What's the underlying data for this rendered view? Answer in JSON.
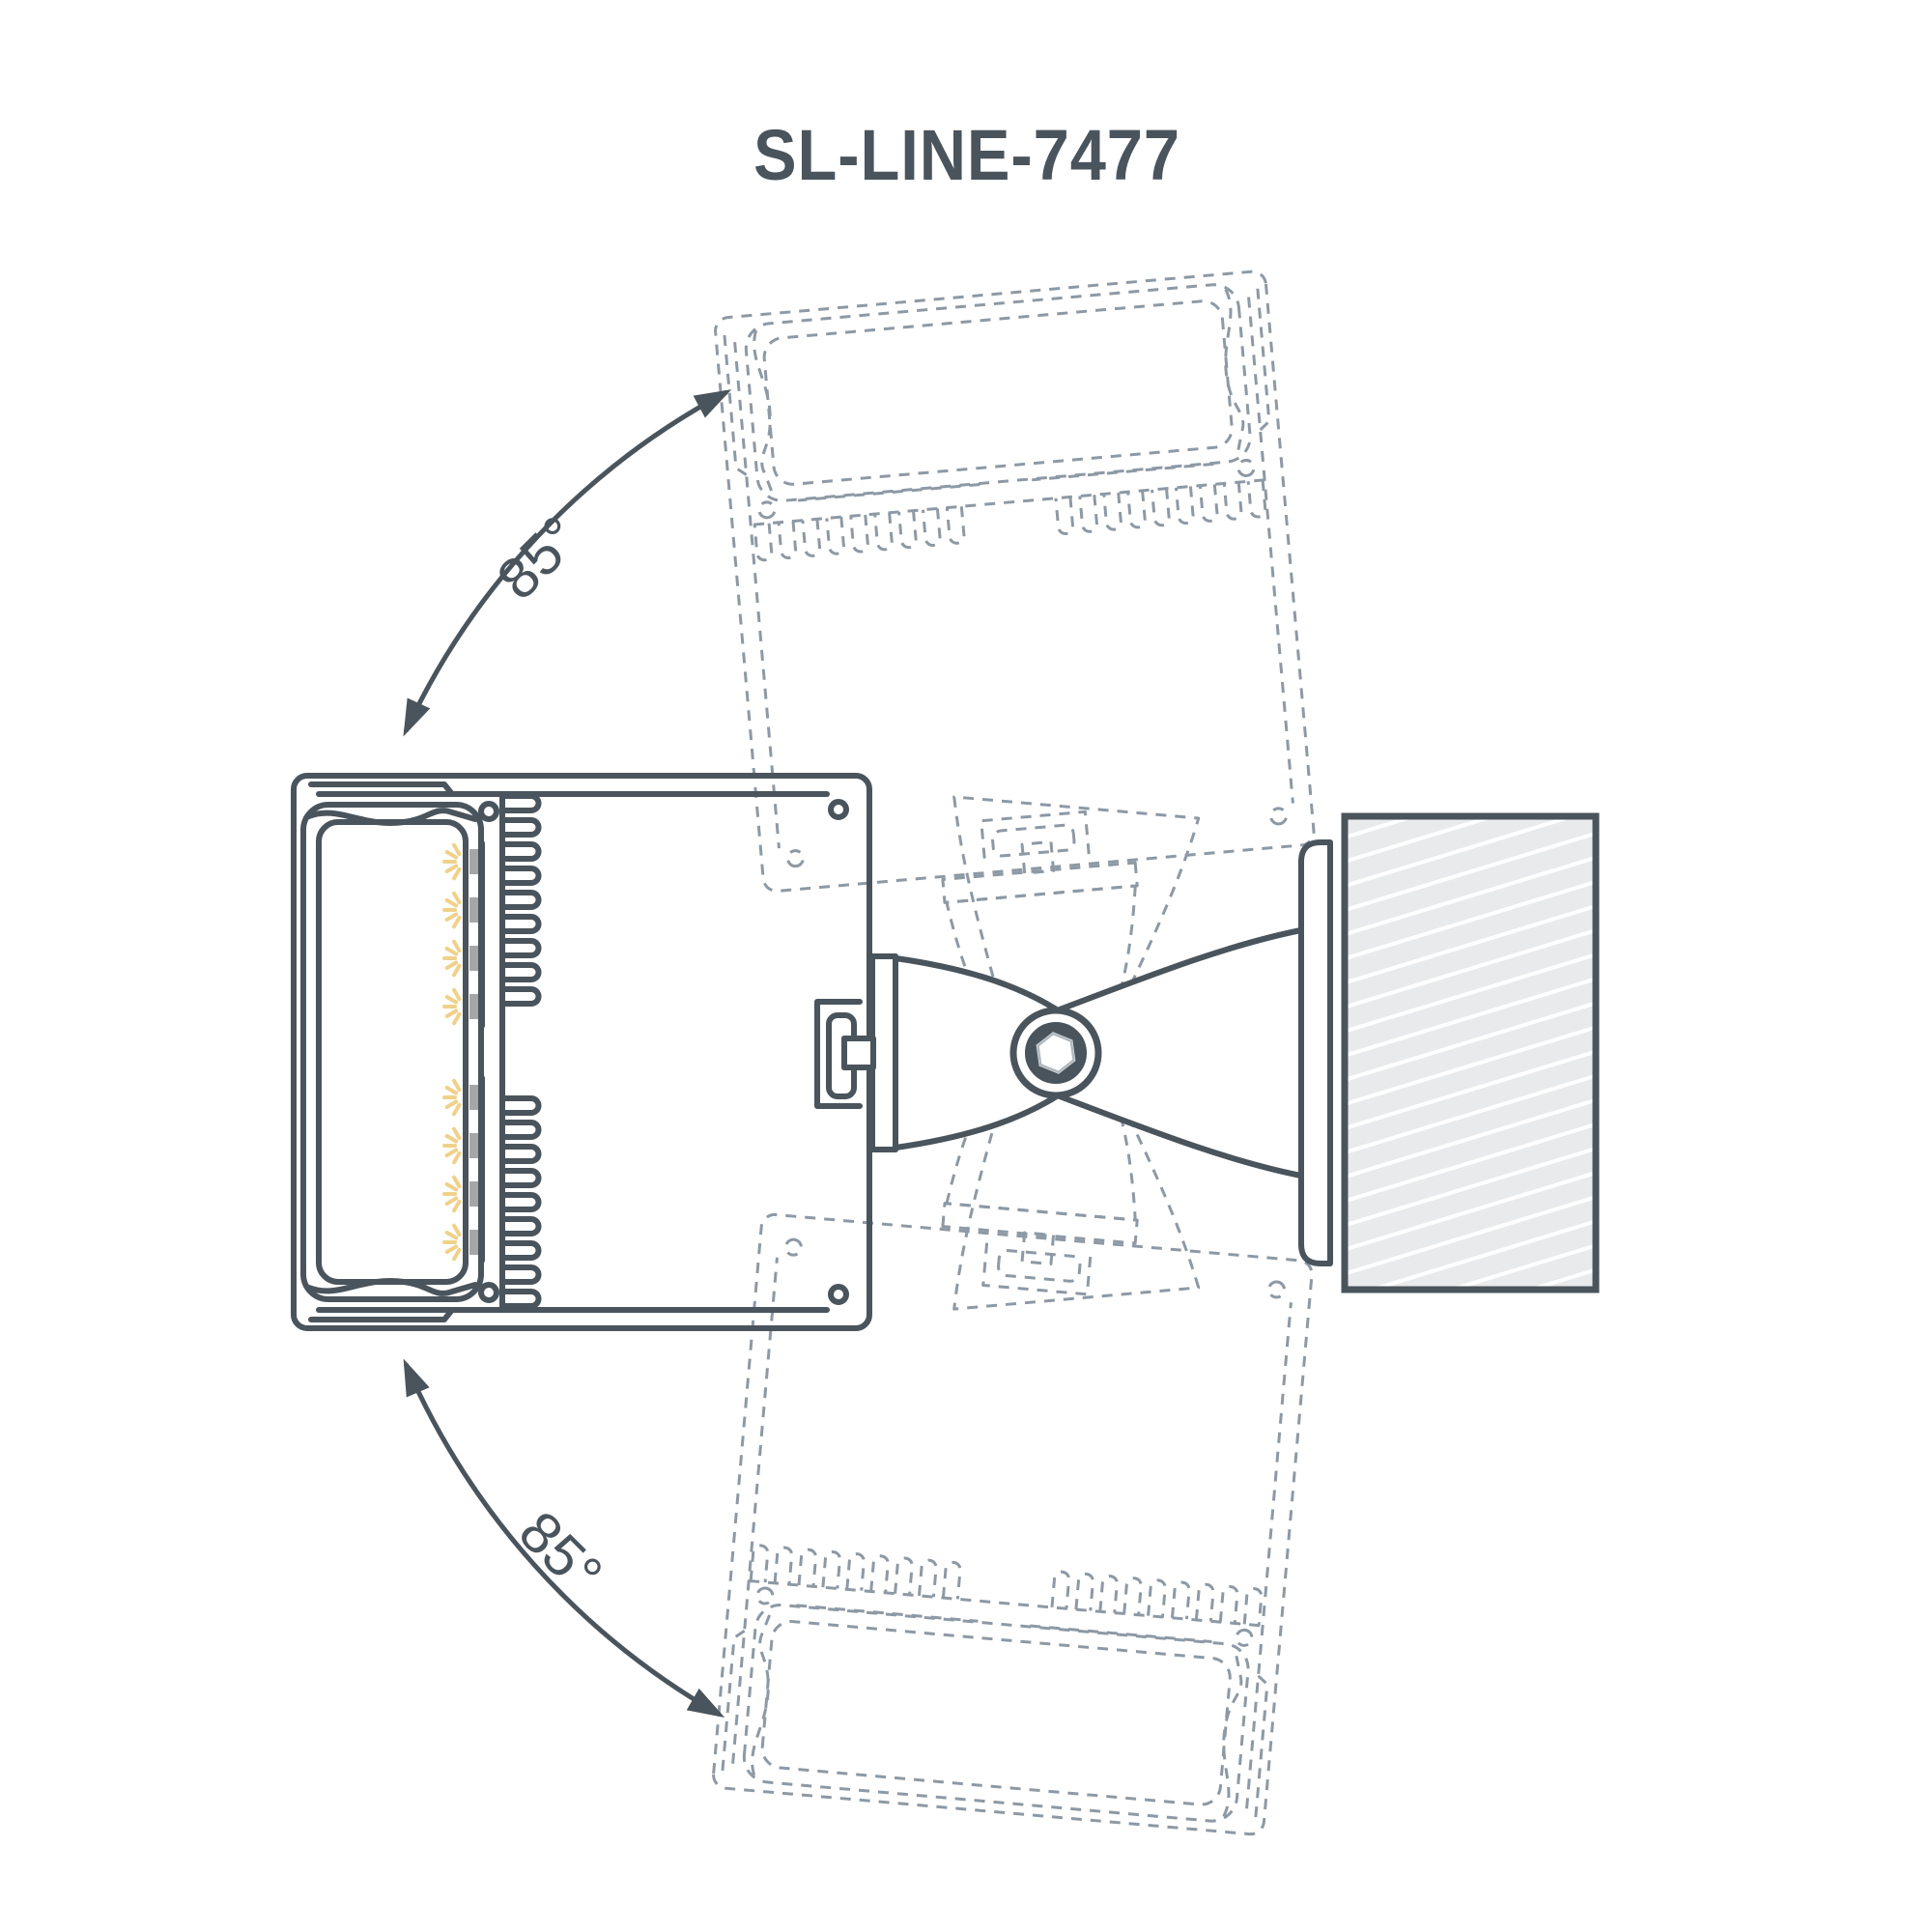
{
  "title": {
    "text": "SL-LINE-7477"
  },
  "annotations": {
    "rotation_up_label": "85°",
    "rotation_down_label": "85°"
  },
  "colors": {
    "ink": "#4a545c",
    "ghost": "#8d99a4",
    "led_glow": "#f0d18b",
    "led_chip": "#a6a6a6",
    "wall_fill": "#e9eaeb",
    "hatch_line": "#ffffff",
    "hex_inner": "#b0b8bf",
    "background": "#ffffff"
  },
  "parts": {
    "fixture": "linear-luminaire-cross-section",
    "lens": "diffuser-lens",
    "led_strip": "led-board",
    "heatsink": "heatsink-fins",
    "bracket": "swivel-mounting-bracket",
    "pivot": "hex-socket-pivot-bolt",
    "wall": "mounting-surface-hatched",
    "ghost_up": "fixture-rotated-up-85",
    "ghost_down": "fixture-rotated-down-85"
  }
}
